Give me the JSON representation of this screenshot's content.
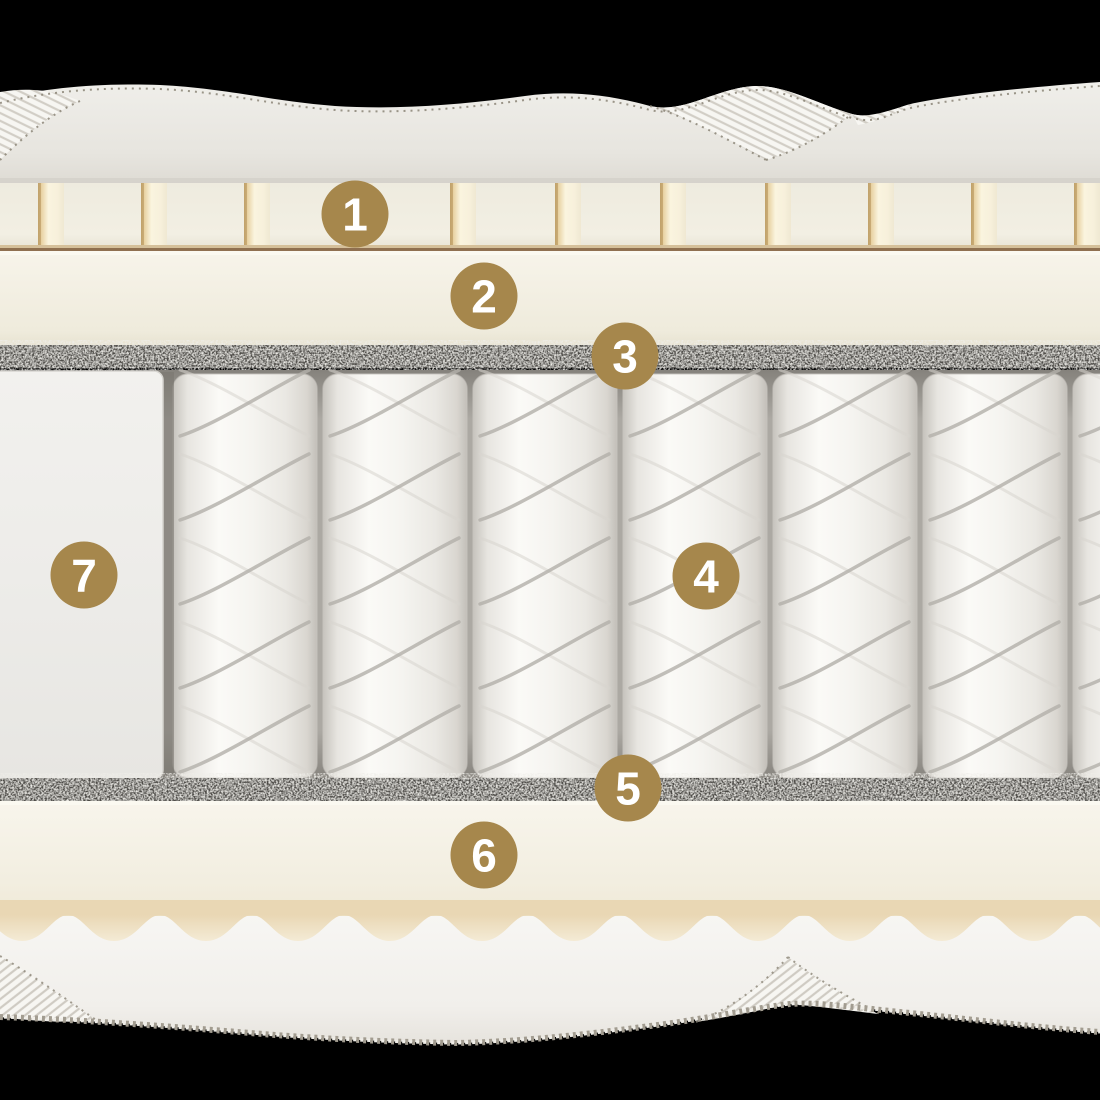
{
  "scene": {
    "width": 1100,
    "height": 1100,
    "background": "#000000",
    "description_type": "mattress-layer-cutaway"
  },
  "badges": {
    "shape": "circle-icon",
    "color": "#A6874C",
    "text_color": "#FFFFFF",
    "labels": [
      {
        "number": "1",
        "x": 355,
        "y": 214
      },
      {
        "number": "2",
        "x": 484,
        "y": 296
      },
      {
        "number": "3",
        "x": 625,
        "y": 356
      },
      {
        "number": "4",
        "x": 706,
        "y": 576
      },
      {
        "number": "5",
        "x": 628,
        "y": 788
      },
      {
        "number": "6",
        "x": 484,
        "y": 855
      },
      {
        "number": "7",
        "x": 84,
        "y": 575
      }
    ]
  },
  "colors": {
    "quilt_fabric": "#EAE8E2",
    "rib_fabric": "#F7F6F2",
    "foam_cream": "#F2EFE3",
    "slat_highlight": "#FAF4DF",
    "liner_tan": "#8F7050",
    "felt_gray": "#4D4B47",
    "spring_fabric": "#F8F7F4",
    "spring_shadow": "#ACA9A3",
    "bottom_fabric": "#F5F4F0",
    "tooth_tan": "#EAD9B8"
  }
}
